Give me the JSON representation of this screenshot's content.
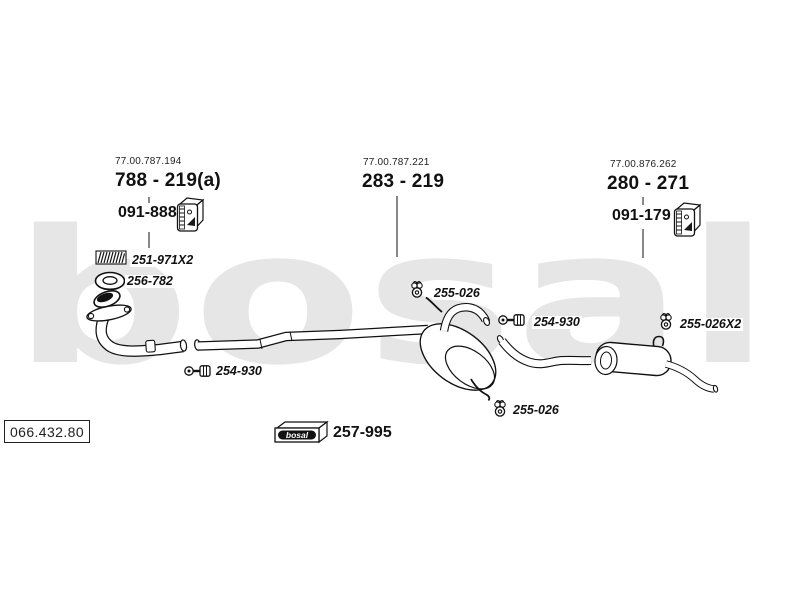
{
  "watermark": "bosal",
  "assemblies": [
    {
      "ref": "77.00.787.194",
      "part": "788 - 219(a)",
      "mount": "091-888"
    },
    {
      "ref": "77.00.787.221",
      "part": "283 - 219"
    },
    {
      "ref": "77.00.876.262",
      "part": "280 - 271",
      "mount": "091-179"
    }
  ],
  "fittings": {
    "gasket_strip": "251-971X2",
    "flange_ring": "256-782",
    "clamp_front": "254-930",
    "hanger_mid_top": "255-026",
    "clamp_mid": "254-930",
    "hanger_rear": "255-026X2",
    "hanger_mid_bottom": "255-026"
  },
  "footer": {
    "diagram_ref": "066.432.80",
    "brand": "bosal",
    "fitting_kit": "257-995"
  }
}
